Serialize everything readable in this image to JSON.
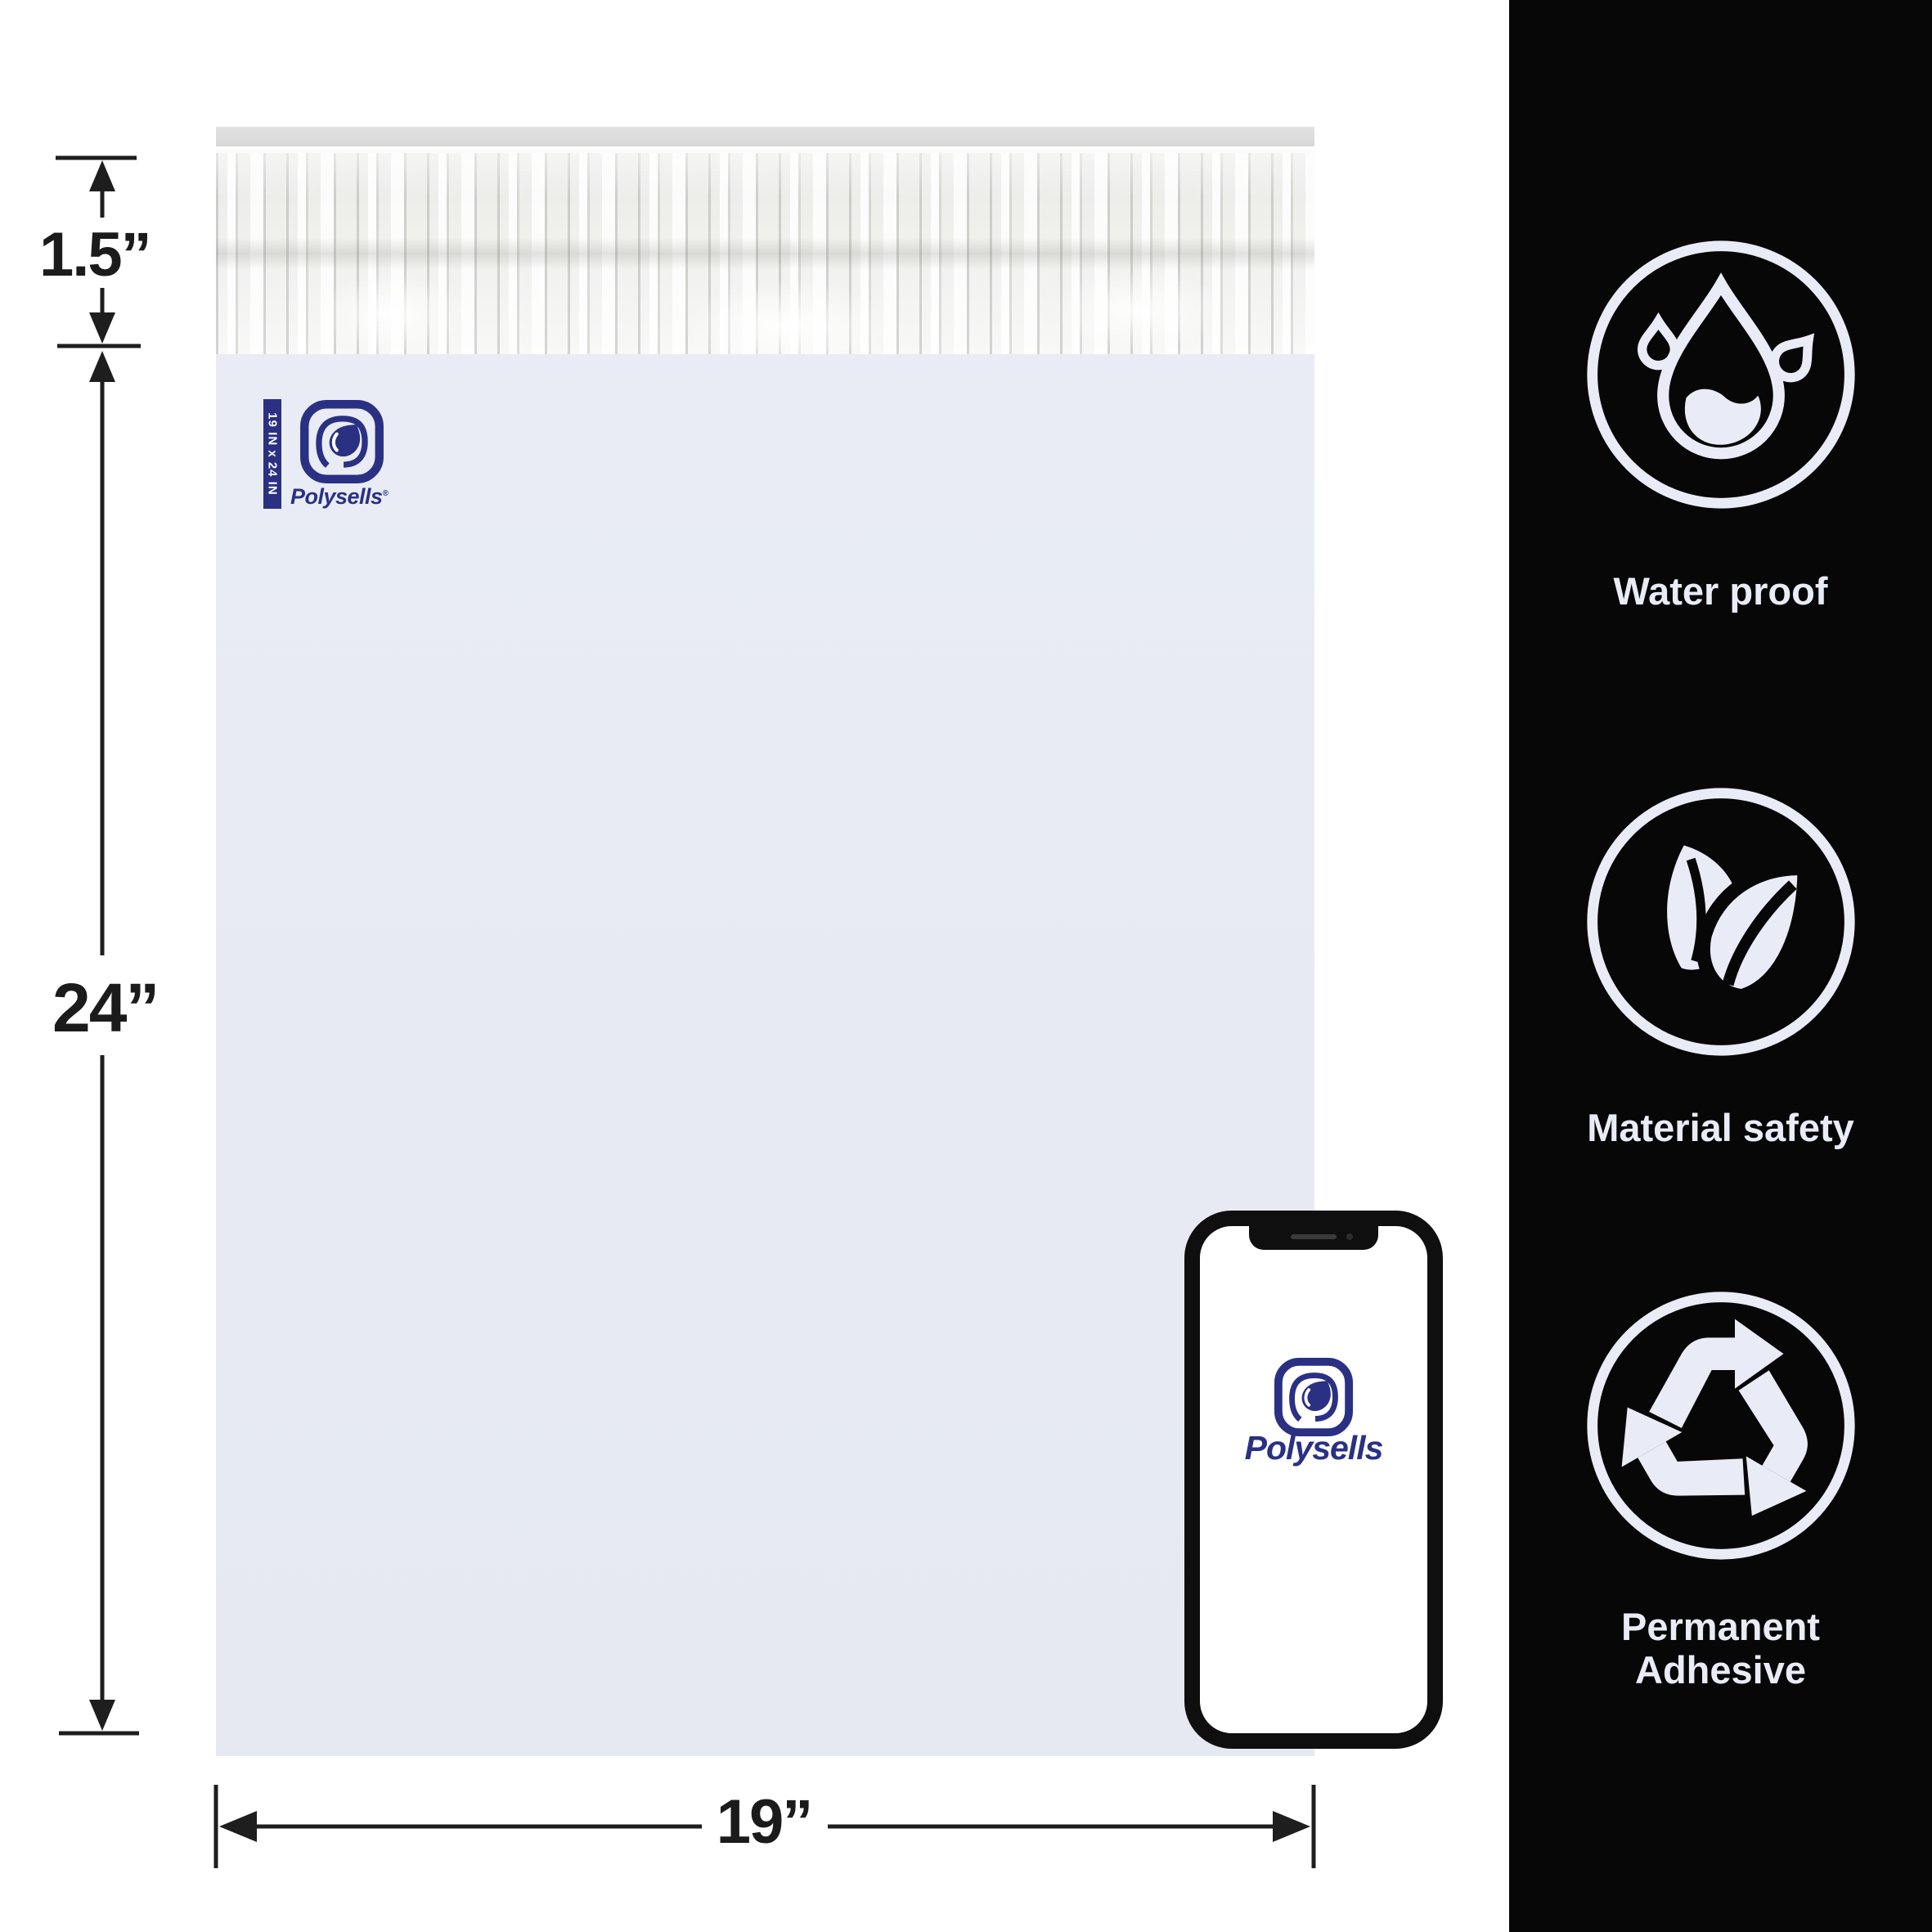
{
  "brand": {
    "name": "Polysells",
    "registered_mark": "®",
    "navy_color": "#2a3183",
    "size_tag": "19 IN x 24 IN"
  },
  "dimensions": {
    "flap_height": "1.5”",
    "bag_height": "24”",
    "bag_width": "19”"
  },
  "bag": {
    "body_color": "#e8ebf4",
    "flap_strip_color": "#dedede"
  },
  "panel": {
    "background_color": "#070707",
    "icon_color": "#e9ecf7",
    "features": [
      {
        "icon": "water-drop-icon",
        "label": "Water proof"
      },
      {
        "icon": "leaves-icon",
        "label": "Material safety"
      },
      {
        "icon": "recycle-icon",
        "label": "Permanent Adhesive"
      }
    ]
  },
  "phone": {
    "screen_logo_text": "Polysells"
  }
}
